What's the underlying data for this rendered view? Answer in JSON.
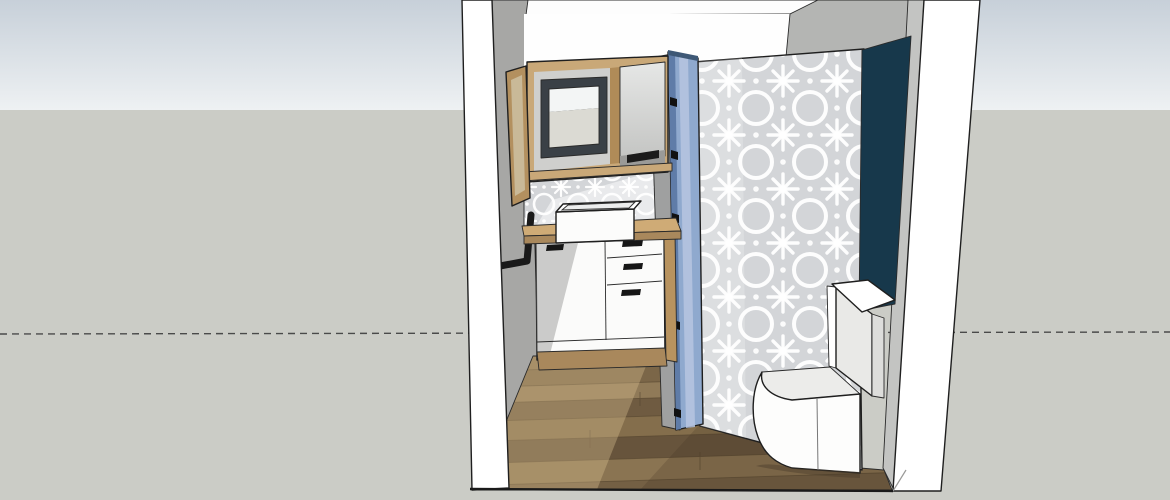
{
  "viewport": {
    "kind": "3d-model-viewport",
    "view_label": "front view into small bathroom model"
  },
  "colors": {
    "sky_top": "#c7d0d9",
    "sky_bottom": "#eef1f3",
    "ground": "#cbccc6",
    "horizon_dash": "#4a4a4a",
    "outline": "#1f1f1f",
    "wall_white": "#ffffff",
    "inner_wall_gray": "#a7a7a5",
    "upper_wall_gray": "#b4b5b3",
    "right_inner_gray": "#c3c4c2",
    "ceiling_white": "#fdfdfd",
    "back_wall_white": "#fefefe",
    "accent_teal": "#17384b",
    "tile_base": "#d3d5d8",
    "tile_motif": "#ffffff",
    "door_blue": "#8fa9ce",
    "door_blue_dark": "#5f7ca8",
    "door_blue_light": "#b7c6e0",
    "door_jamb_gray": "#9fa0a0",
    "hinge_black": "#111111",
    "wood_frame": "#c9a878",
    "wood_dark": "#a9885c",
    "wood_gable": "#b8935f",
    "wood_open_door": "#b3905f",
    "cabinet_white": "#fbfbfa",
    "handle_black": "#161616",
    "mirror_frame": "#3a4046",
    "mirror_glass_top": "#f3f5f5",
    "mirror_glass_bottom": "#dbdad3",
    "shelf_shadow": "#9a9a98",
    "sink_white": "#fcfcfb",
    "toilet_white": "#fdfdfc",
    "toilet_shade": "#e9e9e7",
    "toilet_top": "#ececea",
    "floor_planks": [
      "#8a7351",
      "#7b6648",
      "#907a58",
      "#6f5b41",
      "#846e4c",
      "#67543c",
      "#8a7452",
      "#746044"
    ]
  },
  "objects": {
    "sky": "sky-backdrop",
    "ground": "ground-plane",
    "horizon": "dashed-horizon-line",
    "shell": "bathroom-shell-walls",
    "mirror_cabinet": "wood-mirror-cabinet",
    "open_door_panel": "open-wood-cabinet-door",
    "towel_bar": "black-towel-bar",
    "backsplash": "patterned-tile-backsplash",
    "vanity": "white-vanity-unit",
    "vanity_drawers": 3,
    "vanity_doors": 1,
    "sink": "rectangular-vessel-sink",
    "partition": "patterned-tile-partition-wall",
    "door": "blue-interior-door-open",
    "door_hinges": 4,
    "accent_wall": "dark-teal-accent-wall",
    "toilet": "one-piece-toilet",
    "floor": "wood-plank-floor"
  }
}
